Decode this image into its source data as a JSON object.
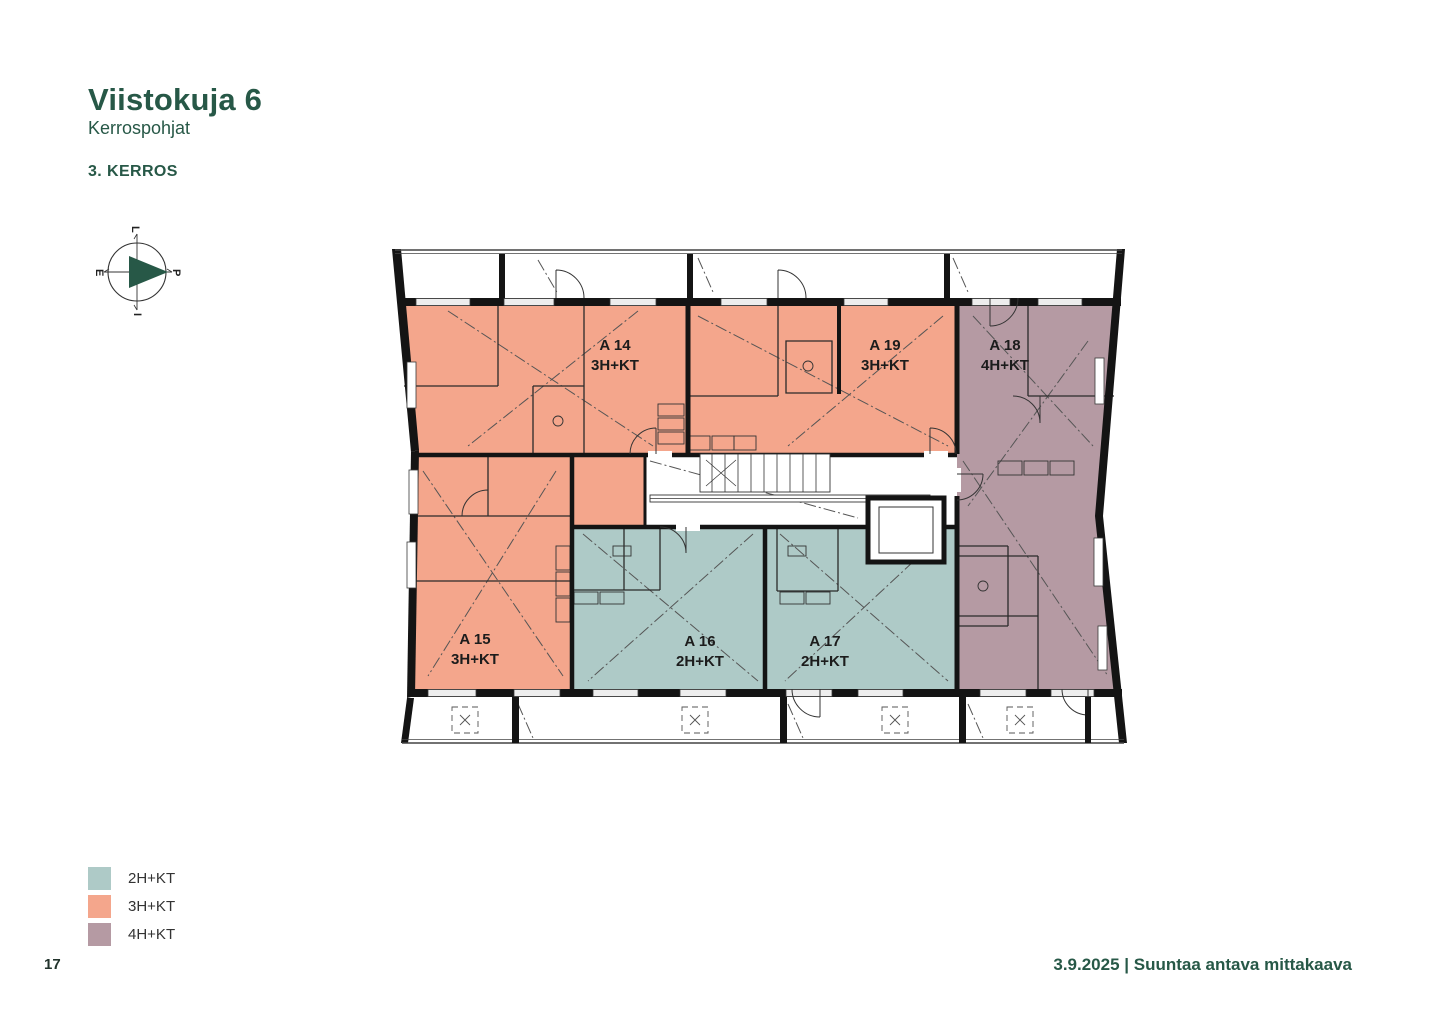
{
  "page": {
    "title": "Viistokuja 6",
    "subtitle": "Kerrospohjat",
    "floor_label": "3. KERROS",
    "page_number": "17",
    "footer_right": "3.9.2025 | Suuntaa antava mittakaava"
  },
  "colors": {
    "accent_green": "#275847",
    "type_2hkt": "#aecac7",
    "type_3hkt": "#f4a68c",
    "type_4hkt": "#b59aa3",
    "wall": "#141414"
  },
  "compass": {
    "top": "L",
    "right": "P",
    "bottom": "I",
    "left": "E"
  },
  "legend": [
    {
      "label": "2H+KT",
      "color": "#aecac7"
    },
    {
      "label": "3H+KT",
      "color": "#f4a68c"
    },
    {
      "label": "4H+KT",
      "color": "#b59aa3"
    }
  ],
  "apartments": [
    {
      "id": "A 14",
      "type": "3H+KT"
    },
    {
      "id": "A 19",
      "type": "3H+KT"
    },
    {
      "id": "A 18",
      "type": "4H+KT"
    },
    {
      "id": "A 15",
      "type": "3H+KT"
    },
    {
      "id": "A 16",
      "type": "2H+KT"
    },
    {
      "id": "A 17",
      "type": "2H+KT"
    }
  ]
}
